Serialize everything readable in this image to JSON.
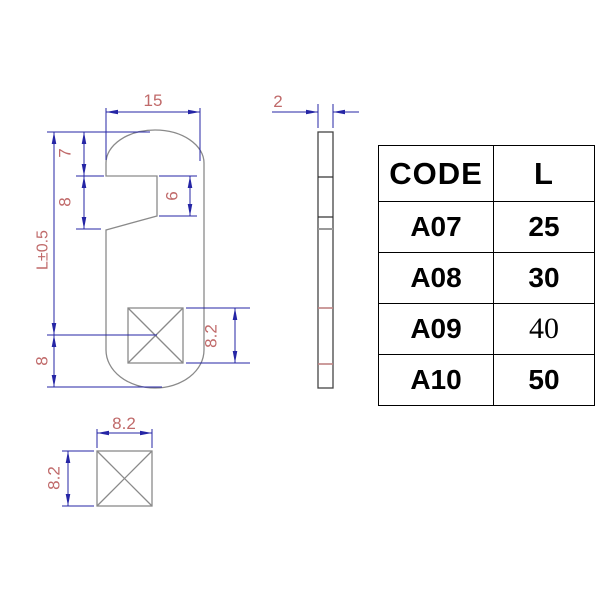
{
  "drawing": {
    "front_view": {
      "dim_width": "15",
      "dim_hook_top": "7",
      "dim_hook_mouth": "8",
      "dim_slot_depth": "6",
      "dim_length": "L±0.5",
      "dim_bottom": "8",
      "dim_pad_height": "8.2"
    },
    "side_view": {
      "dim_thickness": "2"
    },
    "detail_view": {
      "dim_pad_width": "8.2",
      "dim_pad_height": "8.2"
    }
  },
  "table": {
    "headers": {
      "code": "CODE",
      "length": "L"
    },
    "rows": [
      {
        "code": "A07",
        "length": "25"
      },
      {
        "code": "A08",
        "length": "30"
      },
      {
        "code": "A09",
        "length": "40"
      },
      {
        "code": "A10",
        "length": "50"
      }
    ]
  },
  "colors": {
    "dimension_line": "#2525a5",
    "dimension_text": "#c06a6a",
    "part_outline": "#8a8a8a",
    "side_outline": "#444444",
    "pad_section_line": "#c08484",
    "table_border": "#000000"
  }
}
